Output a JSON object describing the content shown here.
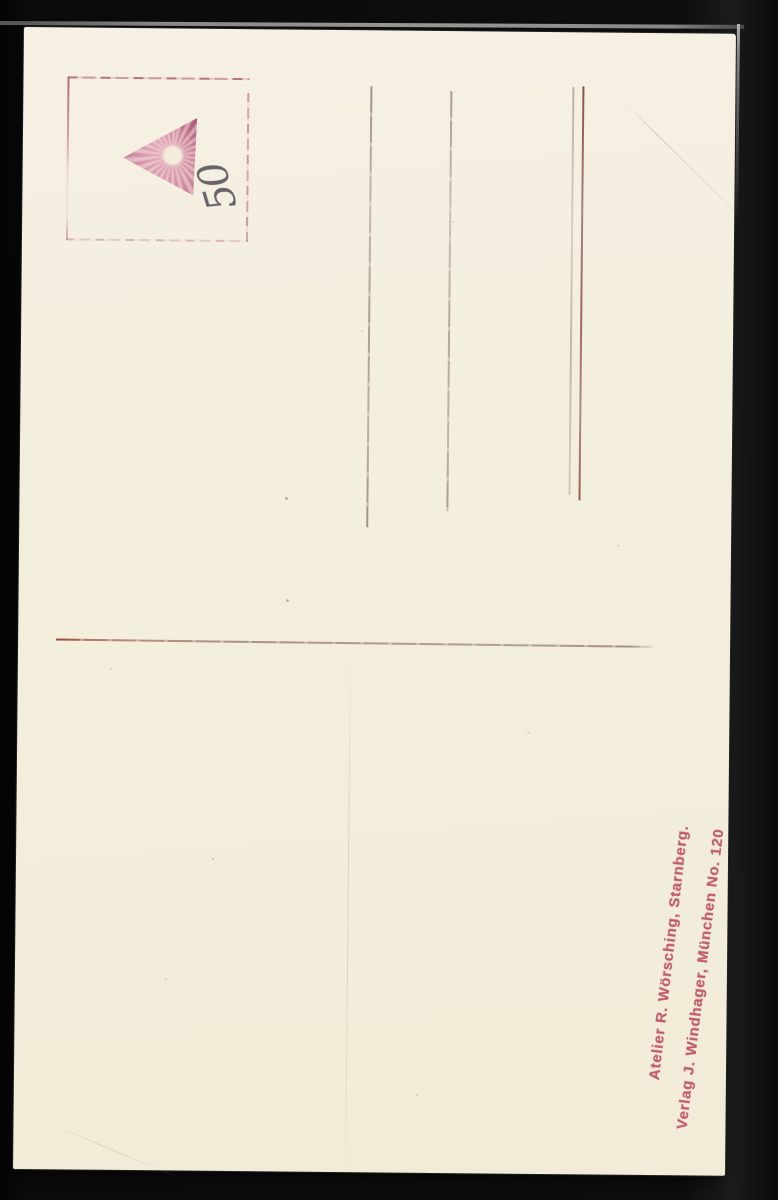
{
  "postcard": {
    "handwriting": {
      "value": "50"
    },
    "publisher": {
      "line1": "Atelier R. Wörsching, Starnberg.",
      "line2": "Verlag J. Windhager, München No. 120"
    },
    "icons": {
      "stamp_mark": "triangle-stamp"
    },
    "colors": {
      "scan_background": "#0d0d0d",
      "card_background": "#f4eedd",
      "stamp_pink": "#c5808f",
      "stamp_box_line": "#b25a62",
      "address_line_gray": "#8d7c6e",
      "address_line_red": "#7f332c",
      "divider_red": "#8a4538",
      "publisher_text": "#c05a6b",
      "handwriting_ink": "#45454c"
    }
  }
}
